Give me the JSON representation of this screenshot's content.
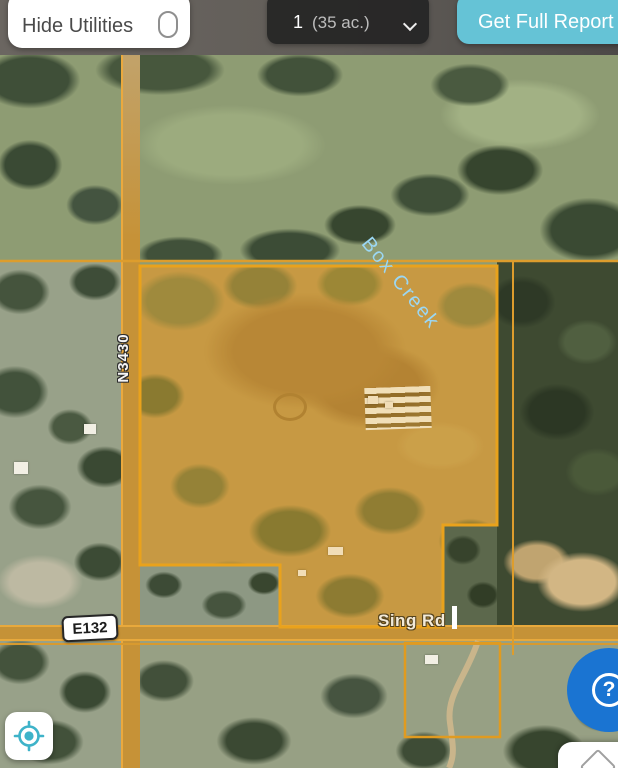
{
  "top_bar": {
    "hide_utilities_label": "Hide Utilities",
    "parcel_selector": {
      "index": "1",
      "acreage": "(35 ac.)"
    },
    "get_full_report_label": "Get Full Report"
  },
  "map_labels": {
    "creek": "Box Creek",
    "vertical_road": "N3430",
    "route_shield": "E132",
    "horizontal_road": "Sing Rd"
  },
  "help_button": {
    "glyph": "?"
  },
  "colors": {
    "accent_teal": "#65c3d6",
    "parcel_orange": "#e9a21c",
    "help_blue": "#1a74d2",
    "creek_label_blue": "#9bd7f3",
    "road_overlay_orange": "#c59237"
  }
}
